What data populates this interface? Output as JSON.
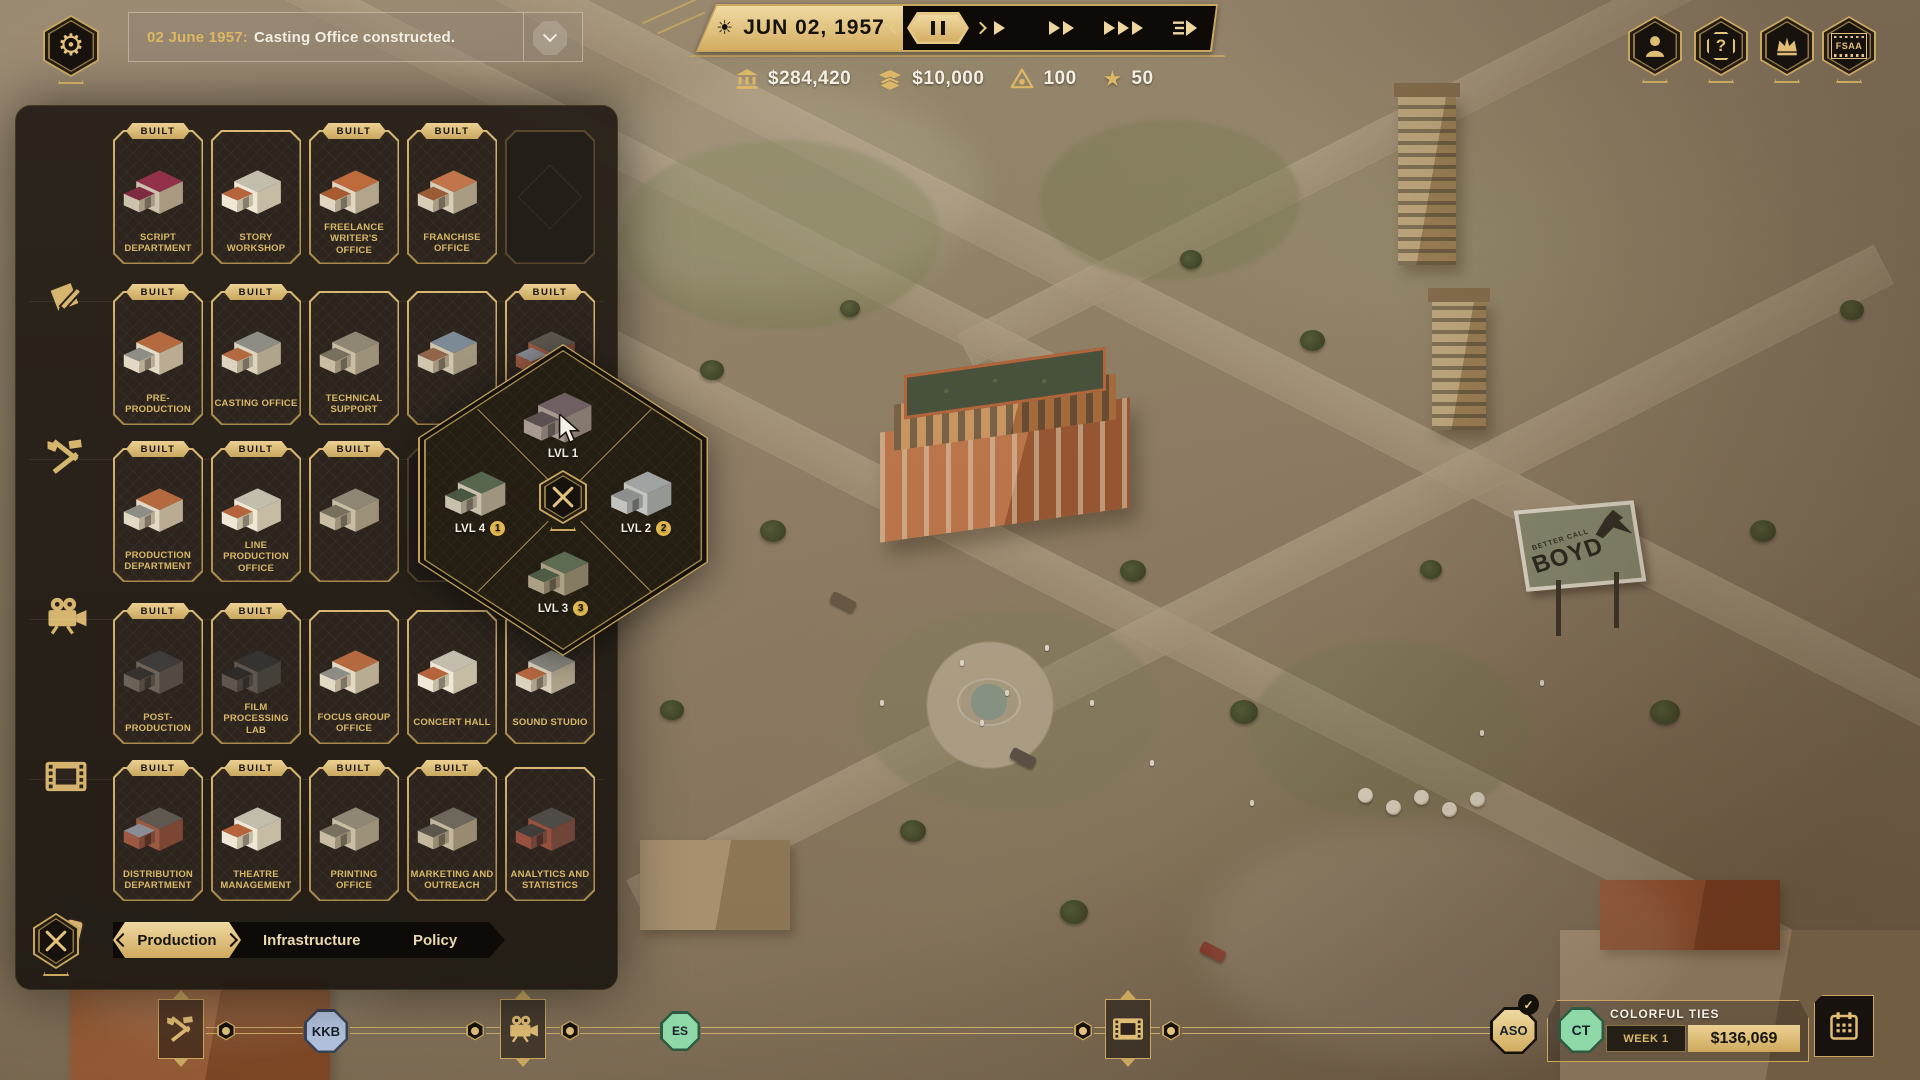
{
  "hud": {
    "notification": {
      "date_label": "02 June 1957:",
      "message": "Casting Office constructed."
    },
    "date_bar": {
      "date": "JUN 02, 1957"
    },
    "resources": [
      {
        "icon": "bank-icon",
        "value": "$284,420"
      },
      {
        "icon": "cash-stack-icon",
        "value": "$10,000"
      },
      {
        "icon": "influence-eye-icon",
        "value": "100"
      },
      {
        "icon": "star-icon",
        "value": "50"
      }
    ],
    "top_right": {
      "fsaa_label": "FSAA"
    }
  },
  "build_panel": {
    "built_badge": "BUILT",
    "tabs": [
      {
        "label": "Production",
        "selected": true
      },
      {
        "label": "Infrastructure",
        "selected": false
      },
      {
        "label": "Policy",
        "selected": false
      }
    ],
    "categories": [
      "script",
      "tools",
      "camera",
      "film",
      "tickets"
    ],
    "rows": [
      [
        {
          "name": "SCRIPT DEPARTMENT",
          "built": true,
          "variant": "red"
        },
        {
          "name": "STORY WORKSHOP",
          "built": false,
          "variant": "white"
        },
        {
          "name": "FREELANCE WRITER'S OFFICE",
          "built": true,
          "variant": "orange"
        },
        {
          "name": "FRANCHISE OFFICE",
          "built": true,
          "variant": "orange2"
        },
        {
          "empty": true
        }
      ],
      [
        {
          "name": "PRE-PRODUCTION",
          "built": true,
          "variant": "cream"
        },
        {
          "name": "CASTING OFFICE",
          "built": true,
          "variant": "cream2"
        },
        {
          "name": "TECHNICAL SUPPORT",
          "built": false,
          "variant": "tan"
        },
        {
          "name": "",
          "built": false,
          "variant": "mixed"
        },
        {
          "name": "SCOUTING OFFICE",
          "built": true,
          "variant": "brick"
        }
      ],
      [
        {
          "name": "PRODUCTION DEPARTMENT",
          "built": true,
          "variant": "cream"
        },
        {
          "name": "LINE PRODUCTION OFFICE",
          "built": true,
          "variant": "white"
        },
        {
          "name": "",
          "built": true,
          "variant": "tan"
        },
        {
          "empty": true
        },
        {
          "empty": true
        }
      ],
      [
        {
          "name": "POST-PRODUCTION",
          "built": true,
          "variant": "dark"
        },
        {
          "name": "FILM PROCESSING LAB",
          "built": true,
          "variant": "dark2"
        },
        {
          "name": "FOCUS GROUP OFFICE",
          "built": false,
          "variant": "cream"
        },
        {
          "name": "CONCERT HALL",
          "built": false,
          "variant": "white"
        },
        {
          "name": "SOUND STUDIO",
          "built": false,
          "variant": "cream2"
        }
      ],
      [
        {
          "name": "DISTRIBUTION DEPARTMENT",
          "built": true,
          "variant": "brick"
        },
        {
          "name": "THEATRE MANAGEMENT",
          "built": true,
          "variant": "white"
        },
        {
          "name": "PRINTING OFFICE",
          "built": true,
          "variant": "tan"
        },
        {
          "name": "MARKETING AND OUTREACH",
          "built": true,
          "variant": "tan2"
        },
        {
          "name": "ANALYTICS AND STATISTICS",
          "built": false,
          "variant": "brick2"
        }
      ]
    ]
  },
  "level_menu": {
    "levels": [
      {
        "label": "LVL 1",
        "badge": "",
        "variant": "mauve"
      },
      {
        "label": "LVL 2",
        "badge": "2",
        "variant": "grey"
      },
      {
        "label": "LVL 3",
        "badge": "3",
        "variant": "brown"
      },
      {
        "label": "LVL 4",
        "badge": "1",
        "variant": "green"
      }
    ]
  },
  "pipeline": {
    "badges": [
      {
        "label": "KKB",
        "fill": "#b3c3df",
        "ring": "#3c4556"
      },
      {
        "label": "ES",
        "fill": "#8fd9a9",
        "ring": "#2f5940"
      },
      {
        "label": "ASO",
        "fill": "#e8cf92",
        "ring": "#171209",
        "check": "✓"
      }
    ],
    "project": {
      "initials": "CT",
      "title": "COLORFUL TIES",
      "week": "WEEK 1",
      "amount": "$136,069"
    }
  },
  "map": {
    "billboard": {
      "top": "BETTER CALL",
      "main": "BOYD"
    }
  }
}
